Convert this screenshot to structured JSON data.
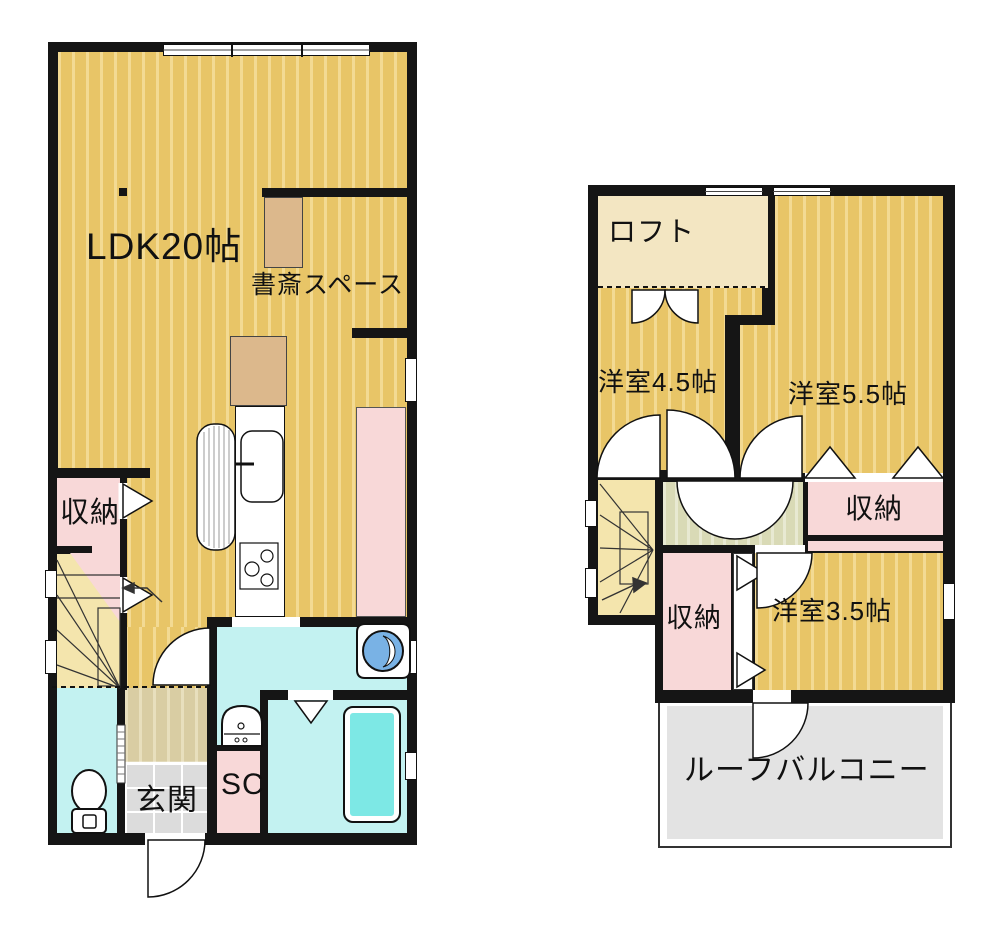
{
  "floors": {
    "first": {
      "labels": {
        "ldk": "LDK20帖",
        "study": "書斎スペース",
        "storage": "収納",
        "entrance": "玄関",
        "shoe_closet": "SC"
      }
    },
    "second": {
      "labels": {
        "loft": "ロフト",
        "room_4_5": "洋室4.5帖",
        "room_5_5": "洋室5.5帖",
        "storage_right": "収納",
        "storage_left": "収納",
        "room_3_5": "洋室3.5帖",
        "roof_balcony": "ルーフバルコニー"
      }
    }
  },
  "colors": {
    "wall": "#151515",
    "floor": "#e8c567",
    "floor-stripe": "#f3da93",
    "loft": "#f3e6c2",
    "stair": "#f4e5ad",
    "pink": "#f8d8d8",
    "cyan": "#c3f2f1",
    "tub": "#7de8e5",
    "landing": "#d9dab6",
    "landing-stripe": "#e8e9d2",
    "hall": "#d9cda3",
    "hall-stripe": "#e8dfbd",
    "genkan": "#dcdcdc",
    "balcony": "#e3e3e3",
    "wood": "#dcb88c",
    "washer": "#79b2e5"
  }
}
